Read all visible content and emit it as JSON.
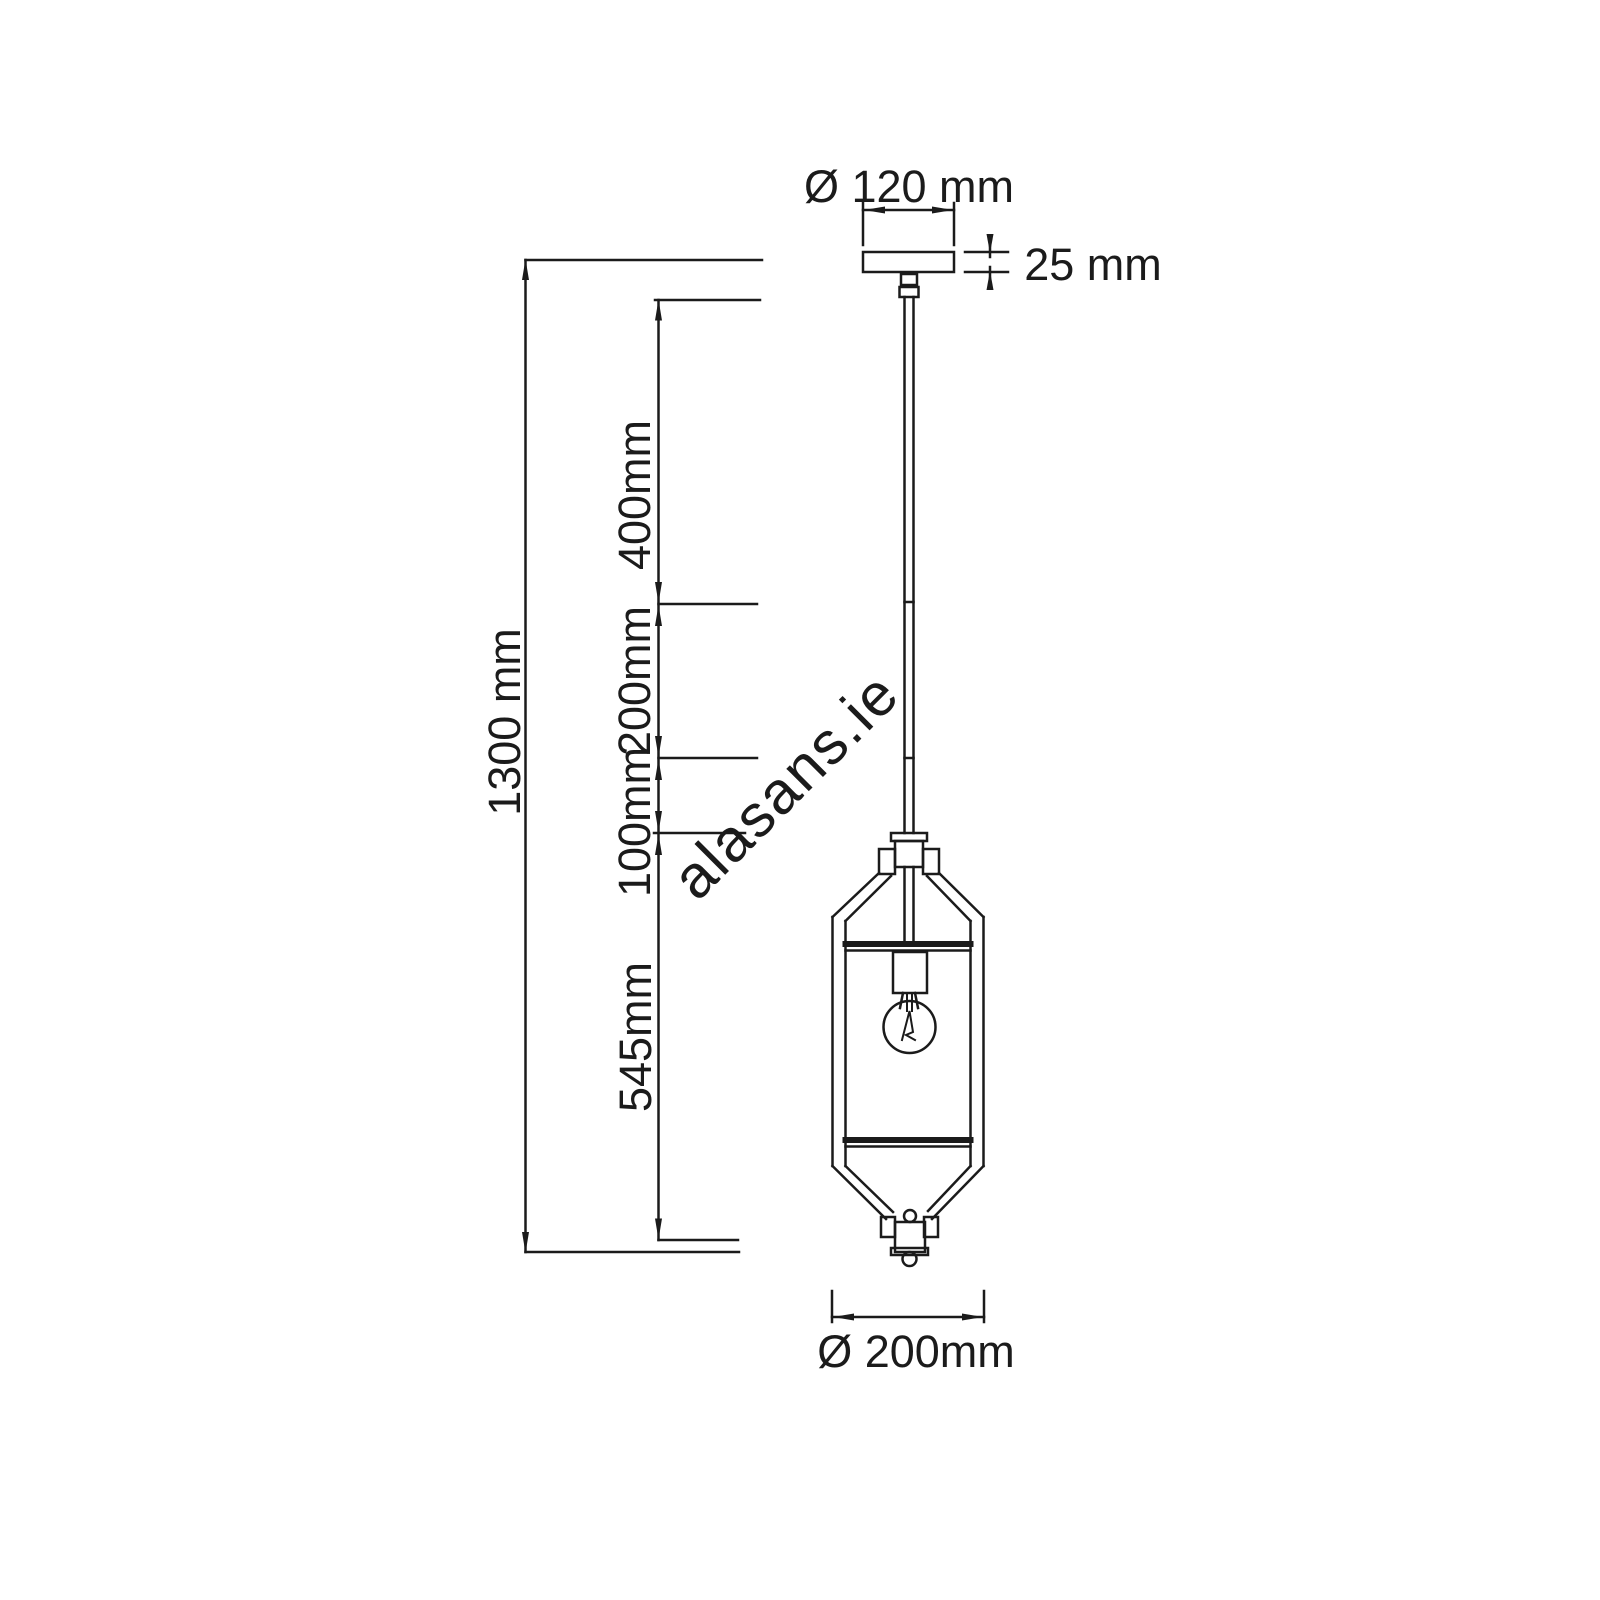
{
  "dimensions": {
    "canopy_diameter": "Ø 120 mm",
    "canopy_height": "25 mm",
    "total_height": "1300 mm",
    "segment_400": "400mm",
    "segment_200": "200mm",
    "segment_100": "100mm",
    "lantern_height": "545mm",
    "lantern_width": "Ø 200mm"
  },
  "watermark": {
    "text": "alasans.ie",
    "color": "#cecece"
  },
  "colors": {
    "line": "#1b1b1b",
    "background": "#ffffff"
  }
}
